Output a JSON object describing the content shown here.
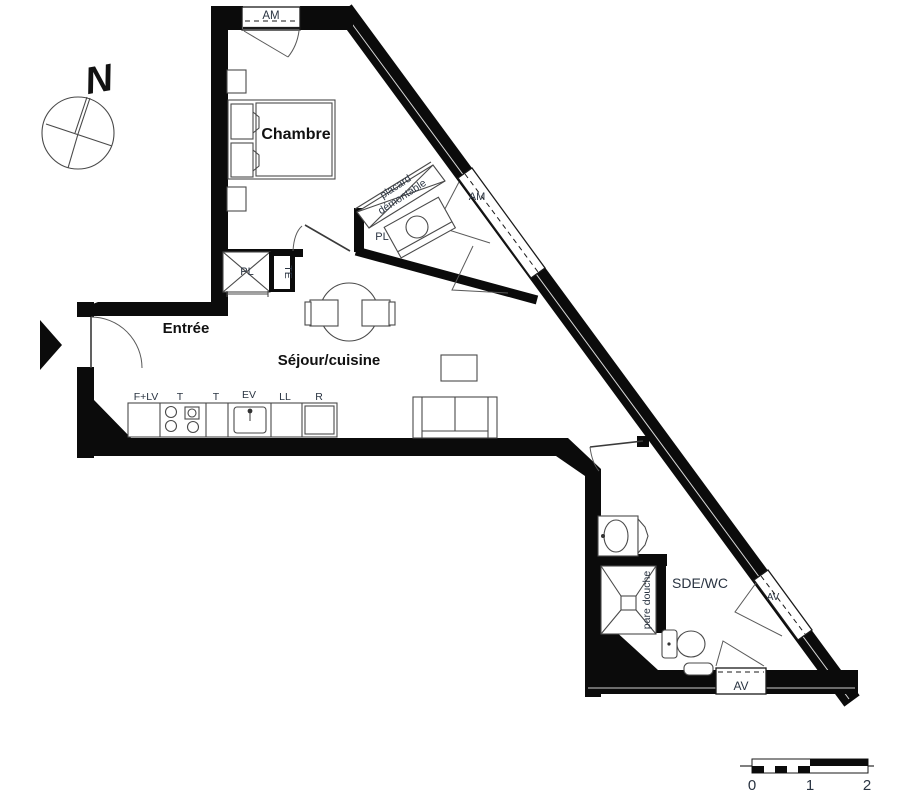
{
  "compass": {
    "north_label": "N"
  },
  "rooms": {
    "bedroom": "Chambre",
    "entry": "Entrée",
    "living": "Séjour/cuisine",
    "bathroom": "SDE/WC"
  },
  "windows": {
    "bedroom_top": "AM",
    "diagonal_upper": "AM",
    "diagonal_lower": "AV",
    "bathroom_bottom": "AV"
  },
  "closets": {
    "nook_label": "PL",
    "hall_closet_label": "PL",
    "te_label": "TE",
    "placard_line1": "placard",
    "placard_line2": "démontable"
  },
  "bathroom": {
    "shower_screen": "pare douche"
  },
  "kitchen": {
    "labels": [
      "F+LV",
      "T",
      "T",
      "EV",
      "LL",
      "R"
    ]
  },
  "scale_bar": {
    "ticks": [
      "0",
      "1",
      "2"
    ]
  },
  "colors": {
    "wall": "#0b0b0b",
    "furniture_line": "#4a4a4a",
    "small_label": "#2a3442",
    "room_label": "#111111"
  }
}
